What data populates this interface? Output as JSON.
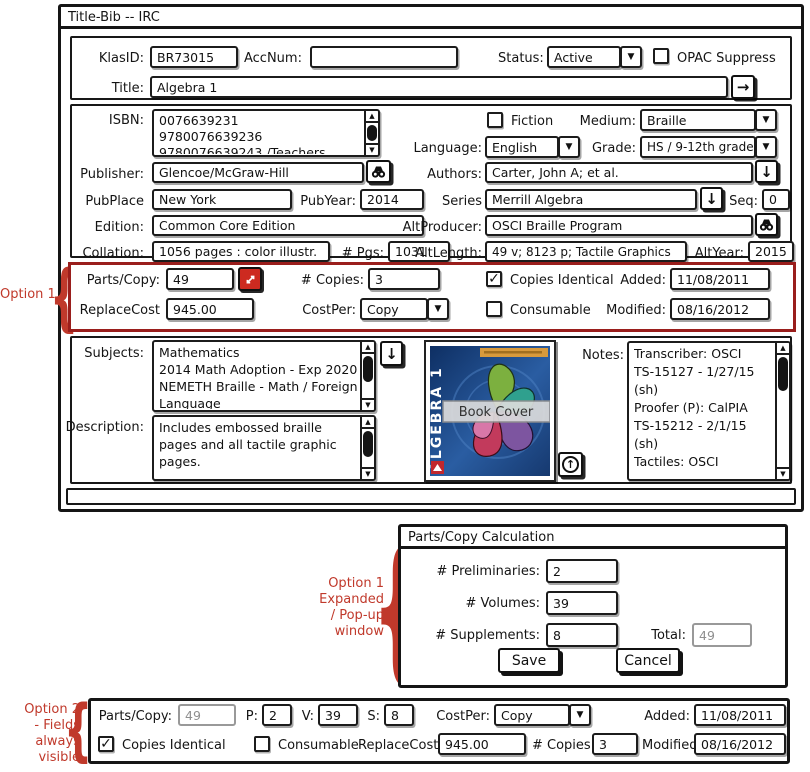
{
  "window": {
    "title": "Title-Bib -- IRC"
  },
  "icons": {
    "dropdown": "▼",
    "scroll_up": "▲",
    "scroll_down": "▼",
    "arrow_right": "→",
    "arrow_down": "↓",
    "arrow_up": "↑"
  },
  "header": {
    "klasid_label": "KlasID:",
    "klasid_value": "BR73015",
    "accnum_label": "AccNum:",
    "accnum_value": "",
    "status_label": "Status:",
    "status_value": "Active",
    "opac_label": "OPAC Suppress",
    "opac_checked": "",
    "title_label": "Title:",
    "title_value": "Algebra 1"
  },
  "bib": {
    "isbn_label": "ISBN:",
    "isbn_lines": [
      "0076639231",
      "9780076639236",
      "9780076639243 /Teachers"
    ],
    "fiction_label": "Fiction",
    "fiction_checked": "",
    "medium_label": "Medium:",
    "medium_value": "Braille",
    "language_label": "Language:",
    "language_value": "English",
    "grade_label": "Grade:",
    "grade_value": "HS / 9-12th grade",
    "publisher_label": "Publisher:",
    "publisher_value": "Glencoe/McGraw-Hill",
    "authors_label": "Authors:",
    "authors_value": "Carter, John A; et al.",
    "pubplace_label": "PubPlace",
    "pubplace_value": "New York",
    "pubyear_label": "PubYear:",
    "pubyear_value": "2014",
    "series_label": "Series",
    "series_value": "Merrill Algebra",
    "seq_label": "Seq:",
    "seq_value": "0",
    "edition_label": "Edition:",
    "edition_value": "Common Core Edition",
    "altproducer_label": "AltProducer:",
    "altproducer_value": "OSCI Braille Program",
    "collation_label": "Collation:",
    "collation_value": "1056 pages : color illustr.",
    "pgs_label": "# Pgs:",
    "pgs_value": "1031",
    "altlength_label": "AltLength:",
    "altlength_value": "49 v; 8123 p; Tactile Graphics",
    "altyear_label": "AltYear:",
    "altyear_value": "2015"
  },
  "option1": {
    "annotation": "Option 1",
    "parts_label": "Parts/Copy:",
    "parts_value": "49",
    "copies_label": "# Copies:",
    "copies_value": "3",
    "identical_label": "Copies Identical",
    "identical_checked": "✓",
    "added_label": "Added:",
    "added_value": "11/08/2011",
    "replacecost_label": "ReplaceCost",
    "replacecost_value": "945.00",
    "costper_label": "CostPer:",
    "costper_value": "Copy",
    "consumable_label": "Consumable",
    "consumable_checked": "",
    "modified_label": "Modified:",
    "modified_value": "08/16/2012"
  },
  "details": {
    "subjects_label": "Subjects:",
    "subjects_lines": [
      "Mathematics",
      "2014 Math Adoption - Exp 2020",
      "NEMETH Braille - Math / Foreign",
      "Language"
    ],
    "description_label": "Description:",
    "description_text": "Includes embossed braille pages and all tactile graphic pages.",
    "notes_label": "Notes:",
    "notes_lines": [
      "Transcriber: OSCI",
      "TS-15127 - 1/27/15",
      "(sh)",
      "Proofer (P): CalPIA",
      "TS-15212 - 2/1/15",
      "(sh)",
      " Tactiles: OSCI"
    ],
    "cover_caption": "Book Cover",
    "cover_spine": "ALGEBRA 1"
  },
  "popup": {
    "title": "Parts/Copy Calculation",
    "annotation_lines": [
      "Option 1",
      "Expanded",
      "/ Pop-up",
      "window"
    ],
    "preliminaries_label": "# Preliminaries:",
    "preliminaries_value": "2",
    "volumes_label": "# Volumes:",
    "volumes_value": "39",
    "supplements_label": "# Supplements:",
    "supplements_value": "8",
    "total_label": "Total:",
    "total_value": "49",
    "save_label": "Save",
    "cancel_label": "Cancel"
  },
  "option2": {
    "annotation_lines": [
      "Option 2",
      "- Fields",
      "always",
      "visible"
    ],
    "parts_label": "Parts/Copy:",
    "parts_value": "49",
    "p_label": "P:",
    "p_value": "2",
    "v_label": "V:",
    "v_value": "39",
    "s_label": "S:",
    "s_value": "8",
    "costper_label": "CostPer:",
    "costper_value": "Copy",
    "added_label": "Added:",
    "added_value": "11/08/2011",
    "identical_label": "Copies Identical",
    "identical_checked": "✓",
    "consumable_label": "Consumable",
    "consumable_checked": "",
    "replacecost_label": "ReplaceCost",
    "replacecost_value": "945.00",
    "copies_label": "# Copies:",
    "copies_value": "3",
    "modified_label": "Modified:",
    "modified_value": "08/16/2012"
  },
  "colors": {
    "annotation_red": "#c0392b",
    "option1_border": "#9a1e1c",
    "expand_button": "#cd2a20"
  }
}
